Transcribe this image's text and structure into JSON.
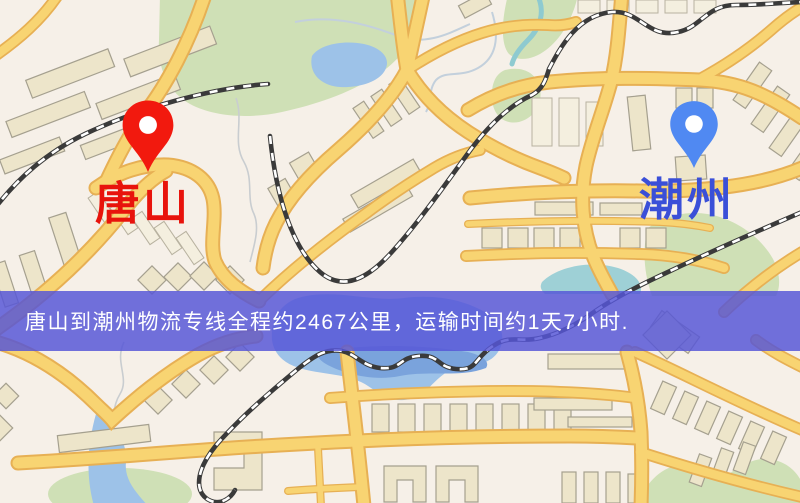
{
  "route": {
    "origin": "唐山",
    "destination": "潮州",
    "distance_text": "2467公里",
    "duration_text": "1天7小时"
  },
  "map": {
    "origin_label": "唐山",
    "destination_label": "潮州",
    "origin_pin_color": "#f2190e",
    "origin_label_color": "#e8130c",
    "destination_pin_color": "#5089f2",
    "destination_label_color": "#3a4fd8",
    "icons": {
      "origin": "red-location-pin-icon",
      "destination": "blue-location-pin-icon"
    }
  },
  "banner": {
    "text": "唐山到潮州物流专线全程约2467公里，运输时间约1天7小时.",
    "background_color": "#5656d6",
    "opacity": 0.84,
    "text_color": "#ffffff"
  },
  "palette": {
    "background": "#f6f0e8",
    "road_fill": "#f8d472",
    "road_casing": "#e7b054",
    "building_fill": "#ede5ca",
    "green_area": "#cfe0b6",
    "water": "#9dc2e8",
    "railway": "#3a3a3a"
  }
}
